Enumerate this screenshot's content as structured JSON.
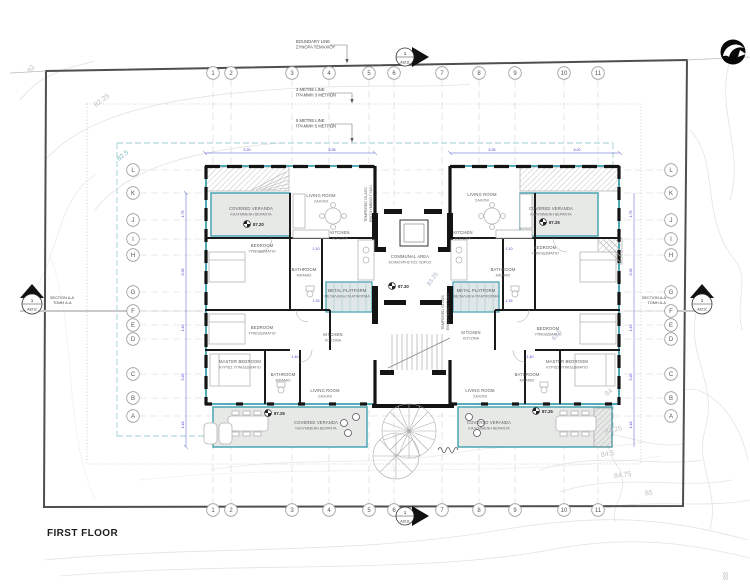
{
  "drawing": {
    "title": "FIRST FLOOR"
  },
  "annotations": {
    "boundary": {
      "en": "BOUNDARY LINE",
      "gr": "ΣΥΝΟΡΑ ΤΕΜΑΧΙΟΥ"
    },
    "line3m": {
      "en": "3 METRE LINE",
      "gr": "ΓΡΑΜΜΗ 3 ΜΕΤΡΩΝ"
    },
    "line5m": {
      "en": "5 METRE LINE",
      "gr": "ΓΡΑΜΜΗ 5 ΜΕΤΡΩΝ"
    },
    "glass": {
      "en": "TEMPERED GLASS",
      "gr": "ΕΝΙΣΧΥΜΕΝΟ ΓΥΑΛΙ"
    }
  },
  "grid": {
    "cols": [
      "1",
      "2",
      "3",
      "4",
      "5",
      "6",
      "7",
      "8",
      "9",
      "10",
      "11"
    ],
    "rows": [
      "L",
      "K",
      "J",
      "I",
      "H",
      "G",
      "F",
      "E",
      "D",
      "C",
      "B",
      "A"
    ]
  },
  "sections": {
    "top": {
      "num": "1",
      "sheet": "A3211"
    },
    "bottom": {
      "num": "1",
      "sheet": "A3211"
    },
    "left": {
      "num": "1",
      "sheet": "A3212",
      "en": "SECTION A-A",
      "gr": "ΤΟΜΗ A-A"
    },
    "right": {
      "num": "1",
      "sheet": "A3212",
      "en": "SECTION A-A",
      "gr": "ΤΟΜΗ A-A"
    }
  },
  "rooms": {
    "veranda": {
      "en": "COVERED VERANDA",
      "gr": "ΚΑΛΥΜΜΕΝΗ ΒΕΡΑΝΤΑ"
    },
    "living": {
      "en": "LIVING ROOM",
      "gr": "ΣΑΛΟΝΙ"
    },
    "kitchen": {
      "en": "KITCHEN",
      "gr": "ΚΟΥΖΙΝΑ"
    },
    "bedroom": {
      "en": "BEDROOM",
      "gr": "ΥΠΝΟΔΩΜΑΤΙΟ"
    },
    "master": {
      "en": "MASTER BEDROOM",
      "gr": "ΚΥΡΙΩΣ ΥΠΝΟΔΩΜΑΤΙΟ"
    },
    "bath": {
      "en": "BATHROOM",
      "gr": "ΜΠΑΝΙΟ"
    },
    "communal": {
      "en": "COMMUNAL AREA",
      "gr": "ΚΟΙΝΟΧΡΗΣΤΟΣ ΧΩΡΟΣ"
    },
    "platform": {
      "en": "METAL PLATFORM",
      "gr": "ΜΕΤΑΛΛΙΚΗ ΠΛΑΤΦΟΡΜΑ"
    }
  },
  "levels": {
    "tl": "87.20",
    "tr": "87.25",
    "bl": "87.25",
    "br": "87.25",
    "communal": "87.30"
  },
  "contours": {
    "c82": "82",
    "c82_25": "82.25",
    "c82_5": "82.5",
    "c83_25": "83.25",
    "c83_5": "83.5",
    "c84": "84",
    "c84_25": "84.25",
    "c84_5": "84.5",
    "c84_75": "84.75",
    "c85": "85",
    "c88": "88"
  },
  "dims": {
    "a": "1.10",
    "b": "1.15",
    "c": "1.40",
    "d": "1.48",
    "e": "1.75",
    "f": "5.20",
    "g": "5.35"
  },
  "colors": {
    "teal": "#3d9faf",
    "dim_blue": "#4040cc",
    "wall": "#141414",
    "veranda_fill": "#e7e9e7"
  }
}
